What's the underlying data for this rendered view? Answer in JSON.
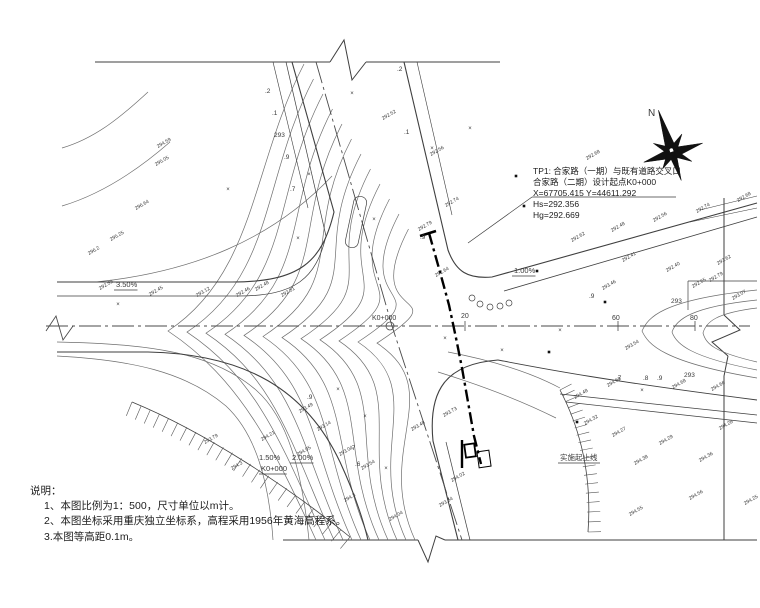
{
  "drawing_type": "road-intersection-topographic-plan",
  "north_label": "N",
  "notes": {
    "header": "说明：",
    "items": [
      "1、本图比例为1：500，尺寸单位以m计。",
      "2、本图坐标采用重庆独立坐标系，高程采用1956年黄海高程系。",
      "3.本图等高距0.1m。"
    ]
  },
  "tp1": {
    "lines": [
      "TP1: 合家路（一期）与既有道路交叉口",
      "合家路（二期）设计起点K0+000",
      "X=67705.415  Y=44611.292",
      "Hs=292.356",
      "Hg=292.669"
    ]
  },
  "boundary_label": {
    "text": "实施起止线",
    "x": 560,
    "y": 460
  },
  "grade_labels": [
    {
      "text": "3.50%",
      "x": 116,
      "y": 287,
      "u": true
    },
    {
      "text": "1.00%",
      "x": 514,
      "y": 273,
      "u": true
    },
    {
      "text": "1.50%",
      "x": 259,
      "y": 460,
      "u": false
    },
    {
      "text": "2.00%",
      "x": 292,
      "y": 460,
      "u": true
    },
    {
      "text": "K0+000",
      "x": 261,
      "y": 471,
      "u": true
    }
  ],
  "station_labels": [
    {
      "text": "K0+000",
      "x": 372,
      "y": 320
    },
    {
      "text": "20",
      "x": 461,
      "y": 318
    },
    {
      "text": "60",
      "x": 612,
      "y": 320
    },
    {
      "text": "80",
      "x": 690,
      "y": 320
    }
  ],
  "contour_labels": [
    {
      "t": ".2",
      "x": 265,
      "y": 93
    },
    {
      "t": ".1",
      "x": 272,
      "y": 115
    },
    {
      "t": "293",
      "x": 274,
      "y": 137
    },
    {
      "t": ".9",
      "x": 284,
      "y": 159
    },
    {
      "t": ".7",
      "x": 290,
      "y": 191
    },
    {
      "t": ".2",
      "x": 397,
      "y": 71
    },
    {
      "t": ".1",
      "x": 404,
      "y": 134
    },
    {
      "t": ".9",
      "x": 420,
      "y": 239
    },
    {
      "t": "293",
      "x": 671,
      "y": 303
    },
    {
      "t": "293",
      "x": 684,
      "y": 377
    },
    {
      "t": ".7",
      "x": 616,
      "y": 380
    },
    {
      "t": ".8",
      "x": 643,
      "y": 380
    },
    {
      "t": ".9",
      "x": 657,
      "y": 380
    },
    {
      "t": ".9",
      "x": 589,
      "y": 298
    },
    {
      "t": ".9",
      "x": 307,
      "y": 399
    },
    {
      "t": ".7",
      "x": 350,
      "y": 450
    },
    {
      "t": ".6",
      "x": 355,
      "y": 466
    }
  ],
  "spot_elevations": [
    {
      "x": 158,
      "y": 148,
      "v": "294.59"
    },
    {
      "x": 156,
      "y": 166,
      "v": "295.05"
    },
    {
      "x": 136,
      "y": 210,
      "v": "296.64"
    },
    {
      "x": 111,
      "y": 241,
      "v": "295.25"
    },
    {
      "x": 89,
      "y": 255,
      "v": "296.2"
    },
    {
      "x": 431,
      "y": 156,
      "v": "292.56"
    },
    {
      "x": 446,
      "y": 207,
      "v": "292.74"
    },
    {
      "x": 419,
      "y": 231,
      "v": "292.79"
    },
    {
      "x": 436,
      "y": 277,
      "v": "292.64"
    },
    {
      "x": 383,
      "y": 120,
      "v": "292.52"
    },
    {
      "x": 587,
      "y": 160,
      "v": "292.68"
    },
    {
      "x": 572,
      "y": 242,
      "v": "292.62"
    },
    {
      "x": 612,
      "y": 232,
      "v": "292.48"
    },
    {
      "x": 654,
      "y": 222,
      "v": "292.56"
    },
    {
      "x": 697,
      "y": 213,
      "v": "292.74"
    },
    {
      "x": 738,
      "y": 202,
      "v": "292.68"
    },
    {
      "x": 623,
      "y": 262,
      "v": "292.41"
    },
    {
      "x": 667,
      "y": 272,
      "v": "292.40"
    },
    {
      "x": 710,
      "y": 282,
      "v": "292.79"
    },
    {
      "x": 733,
      "y": 300,
      "v": "293.07"
    },
    {
      "x": 718,
      "y": 265,
      "v": "293.62"
    },
    {
      "x": 693,
      "y": 288,
      "v": "292.65"
    },
    {
      "x": 100,
      "y": 290,
      "v": "292.59"
    },
    {
      "x": 150,
      "y": 296,
      "v": "292.45"
    },
    {
      "x": 197,
      "y": 297,
      "v": "293.12"
    },
    {
      "x": 237,
      "y": 297,
      "v": "292.46"
    },
    {
      "x": 256,
      "y": 291,
      "v": "292.48"
    },
    {
      "x": 282,
      "y": 297,
      "v": "292.51"
    },
    {
      "x": 626,
      "y": 350,
      "v": "293.54"
    },
    {
      "x": 603,
      "y": 290,
      "v": "293.46"
    },
    {
      "x": 205,
      "y": 444,
      "v": "293.79"
    },
    {
      "x": 232,
      "y": 470,
      "v": "294.3"
    },
    {
      "x": 262,
      "y": 441,
      "v": "294.21"
    },
    {
      "x": 300,
      "y": 413,
      "v": "293.49"
    },
    {
      "x": 318,
      "y": 431,
      "v": "293.14"
    },
    {
      "x": 298,
      "y": 456,
      "v": "294.05"
    },
    {
      "x": 340,
      "y": 456,
      "v": "293.04"
    },
    {
      "x": 362,
      "y": 470,
      "v": "293.54"
    },
    {
      "x": 345,
      "y": 502,
      "v": "294.3"
    },
    {
      "x": 390,
      "y": 521,
      "v": "294.04"
    },
    {
      "x": 412,
      "y": 431,
      "v": "293.48"
    },
    {
      "x": 444,
      "y": 417,
      "v": "293.73"
    },
    {
      "x": 452,
      "y": 482,
      "v": "294.02"
    },
    {
      "x": 440,
      "y": 507,
      "v": "293.64"
    },
    {
      "x": 608,
      "y": 387,
      "v": "294.58"
    },
    {
      "x": 673,
      "y": 389,
      "v": "294.68"
    },
    {
      "x": 712,
      "y": 391,
      "v": "294.66"
    },
    {
      "x": 575,
      "y": 399,
      "v": "294.48"
    },
    {
      "x": 613,
      "y": 437,
      "v": "294.27"
    },
    {
      "x": 635,
      "y": 465,
      "v": "294.38"
    },
    {
      "x": 690,
      "y": 500,
      "v": "294.56"
    },
    {
      "x": 745,
      "y": 505,
      "v": "294.25"
    },
    {
      "x": 630,
      "y": 516,
      "v": "294.55"
    },
    {
      "x": 720,
      "y": 430,
      "v": "294.28"
    },
    {
      "x": 660,
      "y": 445,
      "v": "294.29"
    },
    {
      "x": 700,
      "y": 462,
      "v": "294.36"
    },
    {
      "x": 585,
      "y": 425,
      "v": "294.32"
    }
  ],
  "markers": [
    {
      "x": 352,
      "y": 95,
      "t": "x"
    },
    {
      "x": 309,
      "y": 176,
      "t": "x"
    },
    {
      "x": 374,
      "y": 221,
      "t": "x"
    },
    {
      "x": 228,
      "y": 191,
      "t": "x"
    },
    {
      "x": 432,
      "y": 150,
      "t": "x"
    },
    {
      "x": 502,
      "y": 352,
      "t": "x"
    },
    {
      "x": 338,
      "y": 391,
      "t": "x"
    },
    {
      "x": 386,
      "y": 470,
      "t": "x"
    },
    {
      "x": 560,
      "y": 332,
      "t": "x"
    },
    {
      "x": 642,
      "y": 392,
      "t": "x"
    },
    {
      "x": 118,
      "y": 306,
      "t": "x"
    },
    {
      "x": 470,
      "y": 130,
      "t": "x"
    },
    {
      "x": 365,
      "y": 418,
      "t": "x"
    },
    {
      "x": 445,
      "y": 340,
      "t": "x"
    },
    {
      "x": 298,
      "y": 240,
      "t": "x"
    },
    {
      "x": 516,
      "y": 176,
      "t": "s"
    },
    {
      "x": 524,
      "y": 206,
      "t": "s"
    },
    {
      "x": 537,
      "y": 271,
      "t": "s"
    },
    {
      "x": 549,
      "y": 352,
      "t": "s"
    },
    {
      "x": 577,
      "y": 422,
      "t": "s"
    },
    {
      "x": 605,
      "y": 302,
      "t": "s"
    },
    {
      "x": 472,
      "y": 298,
      "t": "c"
    },
    {
      "x": 480,
      "y": 304,
      "t": "c"
    },
    {
      "x": 490,
      "y": 307,
      "t": "c"
    },
    {
      "x": 500,
      "y": 306,
      "t": "c"
    },
    {
      "x": 509,
      "y": 303,
      "t": "c"
    }
  ],
  "colors": {
    "road_line": "#3f3f3f",
    "contour_line": "#6e6e6e",
    "design_line": "#000000",
    "text": "#2a2a2a"
  }
}
